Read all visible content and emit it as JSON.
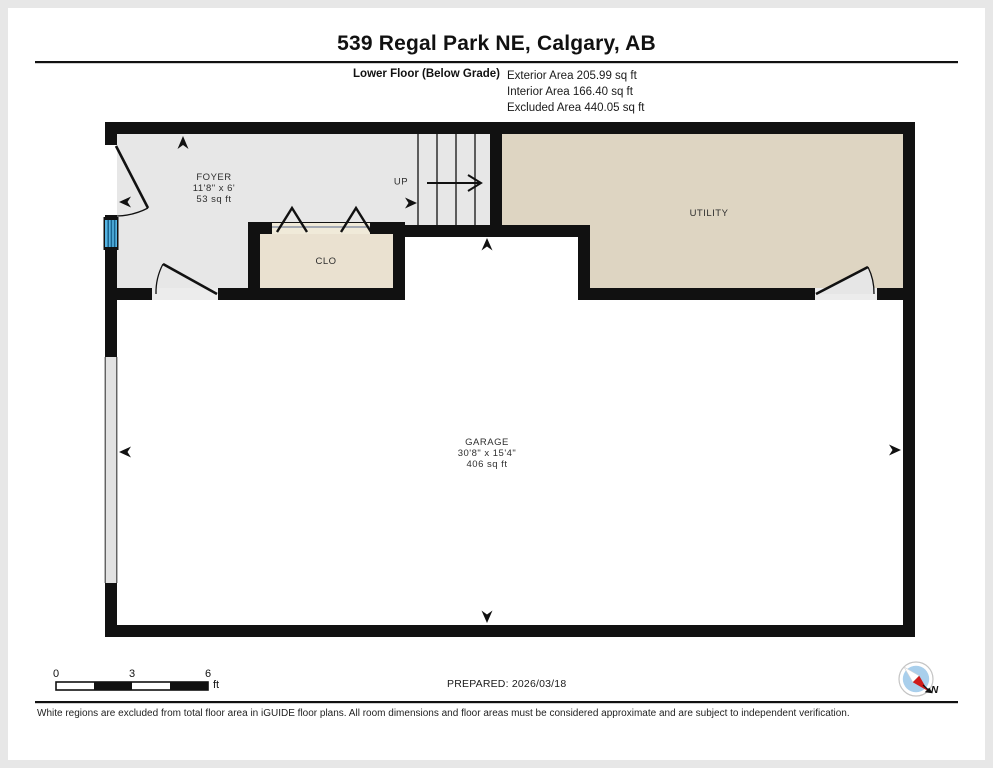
{
  "header": {
    "title": "539 Regal Park NE, Calgary, AB",
    "floor_label": "Lower Floor (Below Grade)",
    "areas": {
      "exterior": "Exterior Area 205.99 sq ft",
      "interior": "Interior Area 166.40 sq ft",
      "excluded": "Excluded Area 440.05 sq ft"
    }
  },
  "rooms": {
    "foyer": {
      "name": "FOYER",
      "dimensions": "11'8\" x 6'",
      "area": "53 sq ft"
    },
    "closet": {
      "name": "CLO"
    },
    "utility": {
      "name": "UTILITY"
    },
    "garage": {
      "name": "GARAGE",
      "dimensions": "30'8\" x 15'4\"",
      "area": "406 sq ft"
    },
    "stairs": {
      "label": "UP"
    }
  },
  "footer": {
    "scale": {
      "tick0": "0",
      "tick3": "3",
      "tick6": "6",
      "unit": "ft"
    },
    "prepared": "PREPARED: 2026/03/18",
    "compass_label": "N",
    "disclaimer": "White regions are excluded from total floor area in iGUIDE floor plans. All room dimensions and floor areas must be considered approximate and are subject to independent verification."
  },
  "colors": {
    "wall": "#111111",
    "foyer_floor": "#e7e7e7",
    "closet_floor": "#eae1d0",
    "utility_floor": "#ded5c2",
    "excluded_floor": "#ffffff",
    "window_blue": "#56b4e2",
    "compass_blue": "#a9cfec",
    "compass_red": "#cf1b1b"
  }
}
